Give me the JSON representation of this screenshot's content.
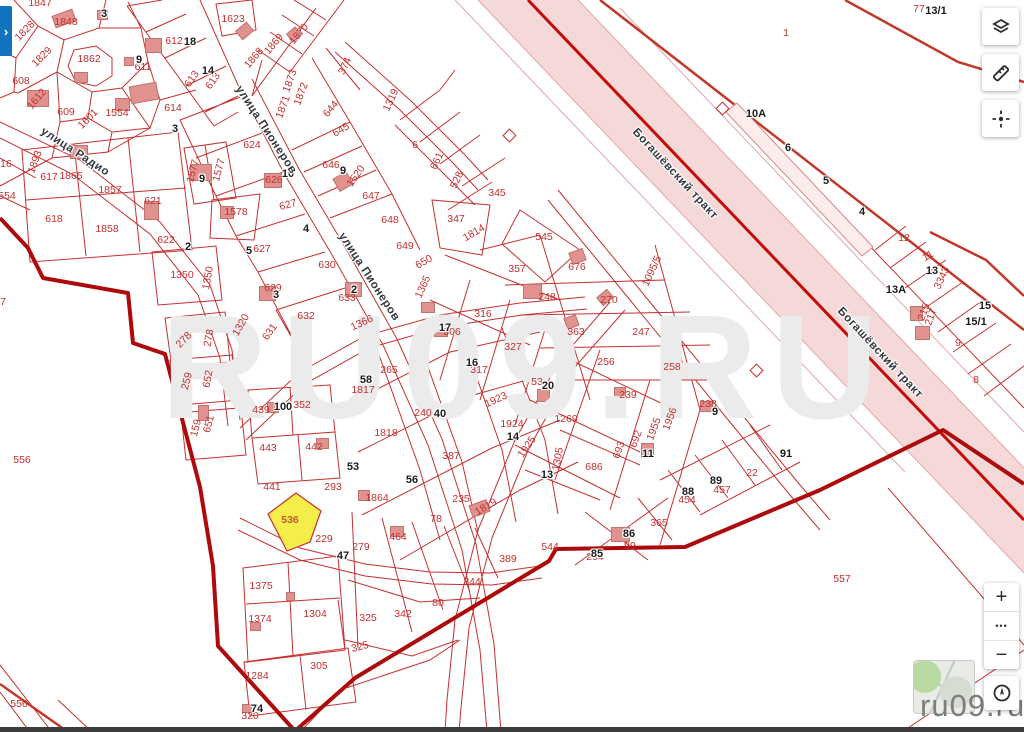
{
  "app": {
    "site_watermark_large": "RU09.RU",
    "site_watermark_small": "ru09.ru"
  },
  "controls": {
    "panel_toggle_glyph": "›",
    "top_right_tools": [
      {
        "name": "layers",
        "title": "Слои"
      },
      {
        "name": "measure",
        "title": "Линейка"
      },
      {
        "name": "position",
        "title": "Позиция"
      }
    ],
    "zoom_in": "+",
    "zoom_menu": "•••",
    "zoom_out": "−",
    "locate": "геолокация",
    "thumbnail": "мини-карта"
  },
  "map": {
    "selected_parcel": {
      "n": "536",
      "x": 290,
      "y": 520
    },
    "colors": {
      "parcel_line": "#c53030",
      "boundary": "#ad0b0b",
      "road_band": "#f5d8d8",
      "road_center": "#c30b0b",
      "building": "#e2928e",
      "selected_fill": "#f5ee4a",
      "parcel_text": "#c22f2f",
      "badge_text": "#1b1b1b",
      "accent_blue": "#1173bd"
    },
    "streets": [
      {
        "t": "улица Радио",
        "x": 75,
        "y": 152,
        "r": 33
      },
      {
        "t": "улица Пионеров",
        "x": 266,
        "y": 130,
        "r": 57
      },
      {
        "t": "улица Пионеров",
        "x": 369,
        "y": 277,
        "r": 57
      },
      {
        "t": "Богашёвский тракт",
        "x": 675,
        "y": 174,
        "r": 47
      },
      {
        "t": "Богашёвский тракт",
        "x": 880,
        "y": 353,
        "r": 47
      }
    ],
    "parcels": [
      [
        "1847",
        40,
        3
      ],
      [
        "1848",
        66,
        22
      ],
      [
        "1828",
        25,
        31,
        -45
      ],
      [
        "1829",
        42,
        57,
        -45
      ],
      [
        "1862",
        89,
        59
      ],
      [
        "608",
        21,
        81
      ],
      [
        "1612",
        37,
        99,
        -50
      ],
      [
        "609",
        66,
        112
      ],
      [
        "1601",
        88,
        119,
        -45
      ],
      [
        "1554",
        117,
        113
      ],
      [
        "612",
        174,
        41
      ],
      [
        "611",
        143,
        67
      ],
      [
        "613",
        192,
        79,
        -55
      ],
      [
        "613",
        213,
        81,
        -55
      ],
      [
        "614",
        173,
        108
      ],
      [
        "1623",
        233,
        19
      ],
      [
        "1870",
        299,
        34,
        -50
      ],
      [
        "1869",
        274,
        44,
        -50
      ],
      [
        "1868",
        254,
        58,
        -50
      ],
      [
        "1873",
        290,
        81,
        -70
      ],
      [
        "1872",
        301,
        94,
        -70
      ],
      [
        "1871",
        283,
        107,
        -70
      ],
      [
        "644",
        331,
        109,
        -50
      ],
      [
        "645",
        341,
        130,
        -30
      ],
      [
        "1319",
        391,
        100,
        -65
      ],
      [
        "374",
        345,
        66,
        -65
      ],
      [
        "6",
        415,
        145
      ],
      [
        "661",
        437,
        161,
        -65
      ],
      [
        "528",
        457,
        180,
        -65
      ],
      [
        "345",
        497,
        193
      ],
      [
        "347",
        456,
        219
      ],
      [
        "1814",
        474,
        233,
        -30
      ],
      [
        "545",
        544,
        237
      ],
      [
        "647",
        371,
        196
      ],
      [
        "648",
        390,
        220
      ],
      [
        "649",
        405,
        246
      ],
      [
        "1520",
        356,
        176,
        -55
      ],
      [
        "646",
        331,
        165
      ],
      [
        "624",
        252,
        145
      ],
      [
        "626",
        274,
        180
      ],
      [
        "627",
        288,
        205,
        -15
      ],
      [
        "627",
        262,
        249
      ],
      [
        "630",
        327,
        265
      ],
      [
        "629",
        273,
        288
      ],
      [
        "633",
        347,
        298
      ],
      [
        "632",
        306,
        316
      ],
      [
        "631",
        270,
        332,
        -55
      ],
      [
        "1320",
        241,
        325,
        -60
      ],
      [
        "1350",
        182,
        275
      ],
      [
        "1350",
        208,
        278,
        -80
      ],
      [
        "617",
        49,
        177
      ],
      [
        "1865",
        71,
        176
      ],
      [
        "1893",
        35,
        162,
        -70
      ],
      [
        "618",
        54,
        219
      ],
      [
        "1857",
        110,
        190
      ],
      [
        "1858",
        107,
        229
      ],
      [
        "621",
        153,
        201
      ],
      [
        "622",
        166,
        240
      ],
      [
        "1578",
        236,
        212
      ],
      [
        "1577",
        193,
        171,
        -75
      ],
      [
        "1577",
        219,
        170,
        -75
      ],
      [
        "16",
        6,
        164
      ],
      [
        "554",
        7,
        196
      ],
      [
        "7",
        3,
        302
      ],
      [
        "556",
        22,
        460
      ],
      [
        "556",
        19,
        704
      ],
      [
        "650",
        424,
        262,
        -30
      ],
      [
        "1365",
        423,
        287,
        -65
      ],
      [
        "1366",
        362,
        323,
        -25
      ],
      [
        "278",
        184,
        340,
        -45
      ],
      [
        "278",
        209,
        338,
        -80
      ],
      [
        "259",
        187,
        381,
        -75
      ],
      [
        "652",
        208,
        379,
        -80
      ],
      [
        "159",
        196,
        428,
        -75
      ],
      [
        "651",
        209,
        424,
        -75
      ],
      [
        "439",
        261,
        410
      ],
      [
        "352",
        302,
        405
      ],
      [
        "443",
        268,
        448
      ],
      [
        "442",
        314,
        447
      ],
      [
        "441",
        272,
        487
      ],
      [
        "293",
        333,
        487
      ],
      [
        "1817",
        363,
        390
      ],
      [
        "265",
        389,
        370
      ],
      [
        "240",
        423,
        413
      ],
      [
        "1818",
        386,
        433
      ],
      [
        "387",
        451,
        456
      ],
      [
        "1864",
        377,
        498
      ],
      [
        "316",
        483,
        314
      ],
      [
        "306",
        452,
        332
      ],
      [
        "327",
        513,
        347
      ],
      [
        "317",
        479,
        370
      ],
      [
        "53",
        537,
        382
      ],
      [
        "248",
        547,
        297
      ],
      [
        "676",
        577,
        267
      ],
      [
        "357",
        517,
        269
      ],
      [
        "270",
        609,
        300
      ],
      [
        "363",
        576,
        332
      ],
      [
        "247",
        641,
        332
      ],
      [
        "256",
        606,
        362
      ],
      [
        "258",
        672,
        367
      ],
      [
        "239",
        628,
        395
      ],
      [
        "238",
        708,
        404
      ],
      [
        "1269",
        566,
        419
      ],
      [
        "1923",
        496,
        400,
        -25
      ],
      [
        "1924",
        512,
        424
      ],
      [
        "1925",
        527,
        447,
        -55
      ],
      [
        "1305",
        558,
        459,
        -80
      ],
      [
        "686",
        594,
        467
      ],
      [
        "692",
        636,
        439,
        -70
      ],
      [
        "693",
        619,
        450,
        -70
      ],
      [
        "1955",
        654,
        429,
        -70
      ],
      [
        "1956",
        670,
        419,
        -70
      ],
      [
        "1095/5",
        652,
        271,
        -65
      ],
      [
        "235",
        461,
        499
      ],
      [
        "1819",
        486,
        507,
        -30
      ],
      [
        "78",
        436,
        519
      ],
      [
        "464",
        398,
        537
      ],
      [
        "279",
        361,
        547
      ],
      [
        "389",
        508,
        559
      ],
      [
        "544",
        550,
        547
      ],
      [
        "344",
        472,
        582
      ],
      [
        "80",
        438,
        603
      ],
      [
        "342",
        403,
        614
      ],
      [
        "325",
        368,
        618
      ],
      [
        "325",
        360,
        647,
        -15
      ],
      [
        "229",
        324,
        539
      ],
      [
        "1375",
        261,
        586
      ],
      [
        "1374",
        260,
        619
      ],
      [
        "1304",
        315,
        614
      ],
      [
        "305",
        319,
        666
      ],
      [
        "1284",
        257,
        676
      ],
      [
        "320",
        250,
        716
      ],
      [
        "365",
        659,
        523
      ],
      [
        "99",
        630,
        546
      ],
      [
        "294",
        595,
        557
      ],
      [
        "454",
        687,
        500
      ],
      [
        "457",
        722,
        490
      ],
      [
        "22",
        752,
        473
      ],
      [
        "557",
        842,
        579
      ],
      [
        "1",
        786,
        33
      ],
      [
        "77",
        919,
        9
      ],
      [
        "12",
        904,
        238
      ],
      [
        "11",
        928,
        256,
        -30
      ],
      [
        "3343",
        942,
        278,
        -65
      ],
      [
        "215",
        924,
        312,
        -70
      ],
      [
        "217",
        931,
        317,
        -70
      ],
      [
        "9",
        958,
        343
      ],
      [
        "8",
        976,
        380
      ]
    ],
    "badges": [
      [
        "3",
        104,
        14
      ],
      [
        "18",
        190,
        42
      ],
      [
        "9",
        139,
        60
      ],
      [
        "14",
        208,
        71
      ],
      [
        "3",
        175,
        129
      ],
      [
        "9",
        343,
        171
      ],
      [
        "10",
        288,
        174
      ],
      [
        "9",
        202,
        179
      ],
      [
        "4",
        306,
        229
      ],
      [
        "2",
        188,
        247
      ],
      [
        "5",
        249,
        251
      ],
      [
        "3",
        276,
        295
      ],
      [
        "2",
        354,
        290
      ],
      [
        "17",
        445,
        328
      ],
      [
        "16",
        472,
        363
      ],
      [
        "58",
        366,
        380
      ],
      [
        "100",
        283,
        407
      ],
      [
        "40",
        440,
        414
      ],
      [
        "20",
        548,
        386
      ],
      [
        "53",
        353,
        467
      ],
      [
        "56",
        412,
        480
      ],
      [
        "14",
        513,
        437
      ],
      [
        "13",
        547,
        475
      ],
      [
        "11",
        648,
        454
      ],
      [
        "9",
        715,
        412
      ],
      [
        "47",
        343,
        556
      ],
      [
        "74",
        257,
        709
      ],
      [
        "85",
        597,
        554
      ],
      [
        "86",
        629,
        534
      ],
      [
        "88",
        688,
        492
      ],
      [
        "89",
        716,
        481
      ],
      [
        "91",
        786,
        454
      ],
      [
        "13/1",
        936,
        11
      ],
      [
        "10A",
        756,
        114
      ],
      [
        "6",
        788,
        148
      ],
      [
        "5",
        826,
        181
      ],
      [
        "4",
        862,
        212
      ],
      [
        "13",
        932,
        271
      ],
      [
        "13A",
        896,
        290
      ],
      [
        "15",
        985,
        306
      ],
      [
        "15/1",
        976,
        322
      ]
    ],
    "buildings": [
      [
        63,
        17,
        20,
        11,
        -20
      ],
      [
        101,
        14,
        9,
        8,
        0
      ],
      [
        152,
        44,
        15,
        13,
        0
      ],
      [
        128,
        60,
        8,
        7,
        0
      ],
      [
        143,
        92,
        26,
        16,
        -10
      ],
      [
        121,
        103,
        13,
        11,
        0
      ],
      [
        37,
        97,
        20,
        15,
        0
      ],
      [
        80,
        76,
        12,
        9,
        0
      ],
      [
        243,
        30,
        13,
        10,
        -40
      ],
      [
        293,
        33,
        10,
        9,
        -40
      ],
      [
        78,
        151,
        16,
        12,
        0
      ],
      [
        200,
        171,
        20,
        15,
        0
      ],
      [
        150,
        209,
        13,
        17,
        0
      ],
      [
        226,
        211,
        12,
        11,
        0
      ],
      [
        272,
        179,
        16,
        13,
        0
      ],
      [
        342,
        180,
        14,
        13,
        -30
      ],
      [
        266,
        292,
        15,
        13,
        0
      ],
      [
        352,
        288,
        15,
        13,
        0
      ],
      [
        272,
        406,
        10,
        9,
        0
      ],
      [
        321,
        442,
        11,
        9,
        0
      ],
      [
        181,
        372,
        7,
        10,
        0
      ],
      [
        202,
        412,
        9,
        14,
        0
      ],
      [
        363,
        494,
        10,
        9,
        0
      ],
      [
        478,
        507,
        17,
        11,
        -20
      ],
      [
        396,
        530,
        12,
        9,
        0
      ],
      [
        542,
        394,
        11,
        11,
        0
      ],
      [
        619,
        391,
        10,
        9,
        0
      ],
      [
        576,
        255,
        13,
        11,
        -20
      ],
      [
        531,
        290,
        17,
        13,
        0
      ],
      [
        570,
        321,
        11,
        10,
        -20
      ],
      [
        604,
        296,
        12,
        9,
        -40
      ],
      [
        513,
        348,
        15,
        17,
        0
      ],
      [
        440,
        329,
        12,
        11,
        0
      ],
      [
        427,
        306,
        12,
        9,
        0
      ],
      [
        675,
        362,
        11,
        11,
        -20
      ],
      [
        705,
        405,
        11,
        9,
        0
      ],
      [
        646,
        449,
        11,
        13,
        0
      ],
      [
        619,
        533,
        17,
        13,
        0
      ],
      [
        254,
        625,
        9,
        7,
        0
      ],
      [
        289,
        595,
        7,
        7,
        0
      ],
      [
        247,
        707,
        10,
        7,
        0
      ],
      [
        915,
        312,
        11,
        13,
        0
      ],
      [
        921,
        332,
        13,
        12,
        0
      ]
    ]
  }
}
